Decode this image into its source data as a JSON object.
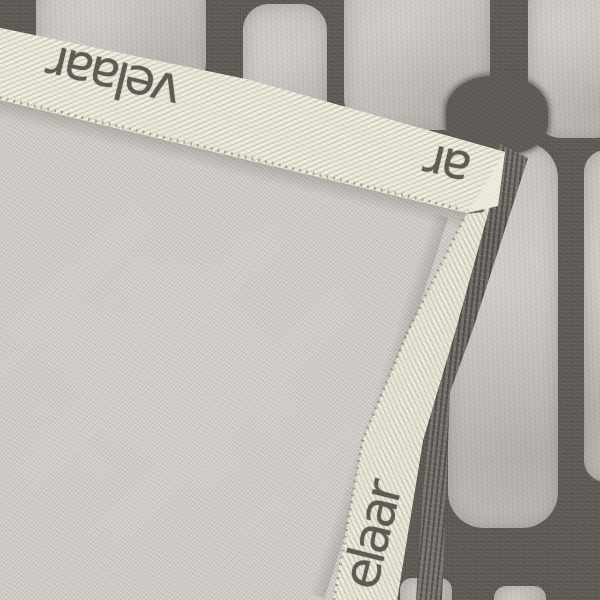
{
  "scene": {
    "alt": "Close-up photo of a rug corner folded over, showing the light grey woven backing bound with a cream herringbone brand tape, lying on the rug's charcoal front with large light-grey stone shapes"
  },
  "brand": {
    "label_top": "velaar",
    "label_corner_fragment": "ar",
    "label_fold_fragment": "ve",
    "label_right": "elaar"
  },
  "colors": {
    "front_background": "#5e5a55",
    "front_stone": "#c8c5c0",
    "backing_canvas": "#d3d0cb",
    "binding_tape": "#ece8db",
    "brand_text": "#4a4743",
    "pile_edge": "#7b7671"
  }
}
